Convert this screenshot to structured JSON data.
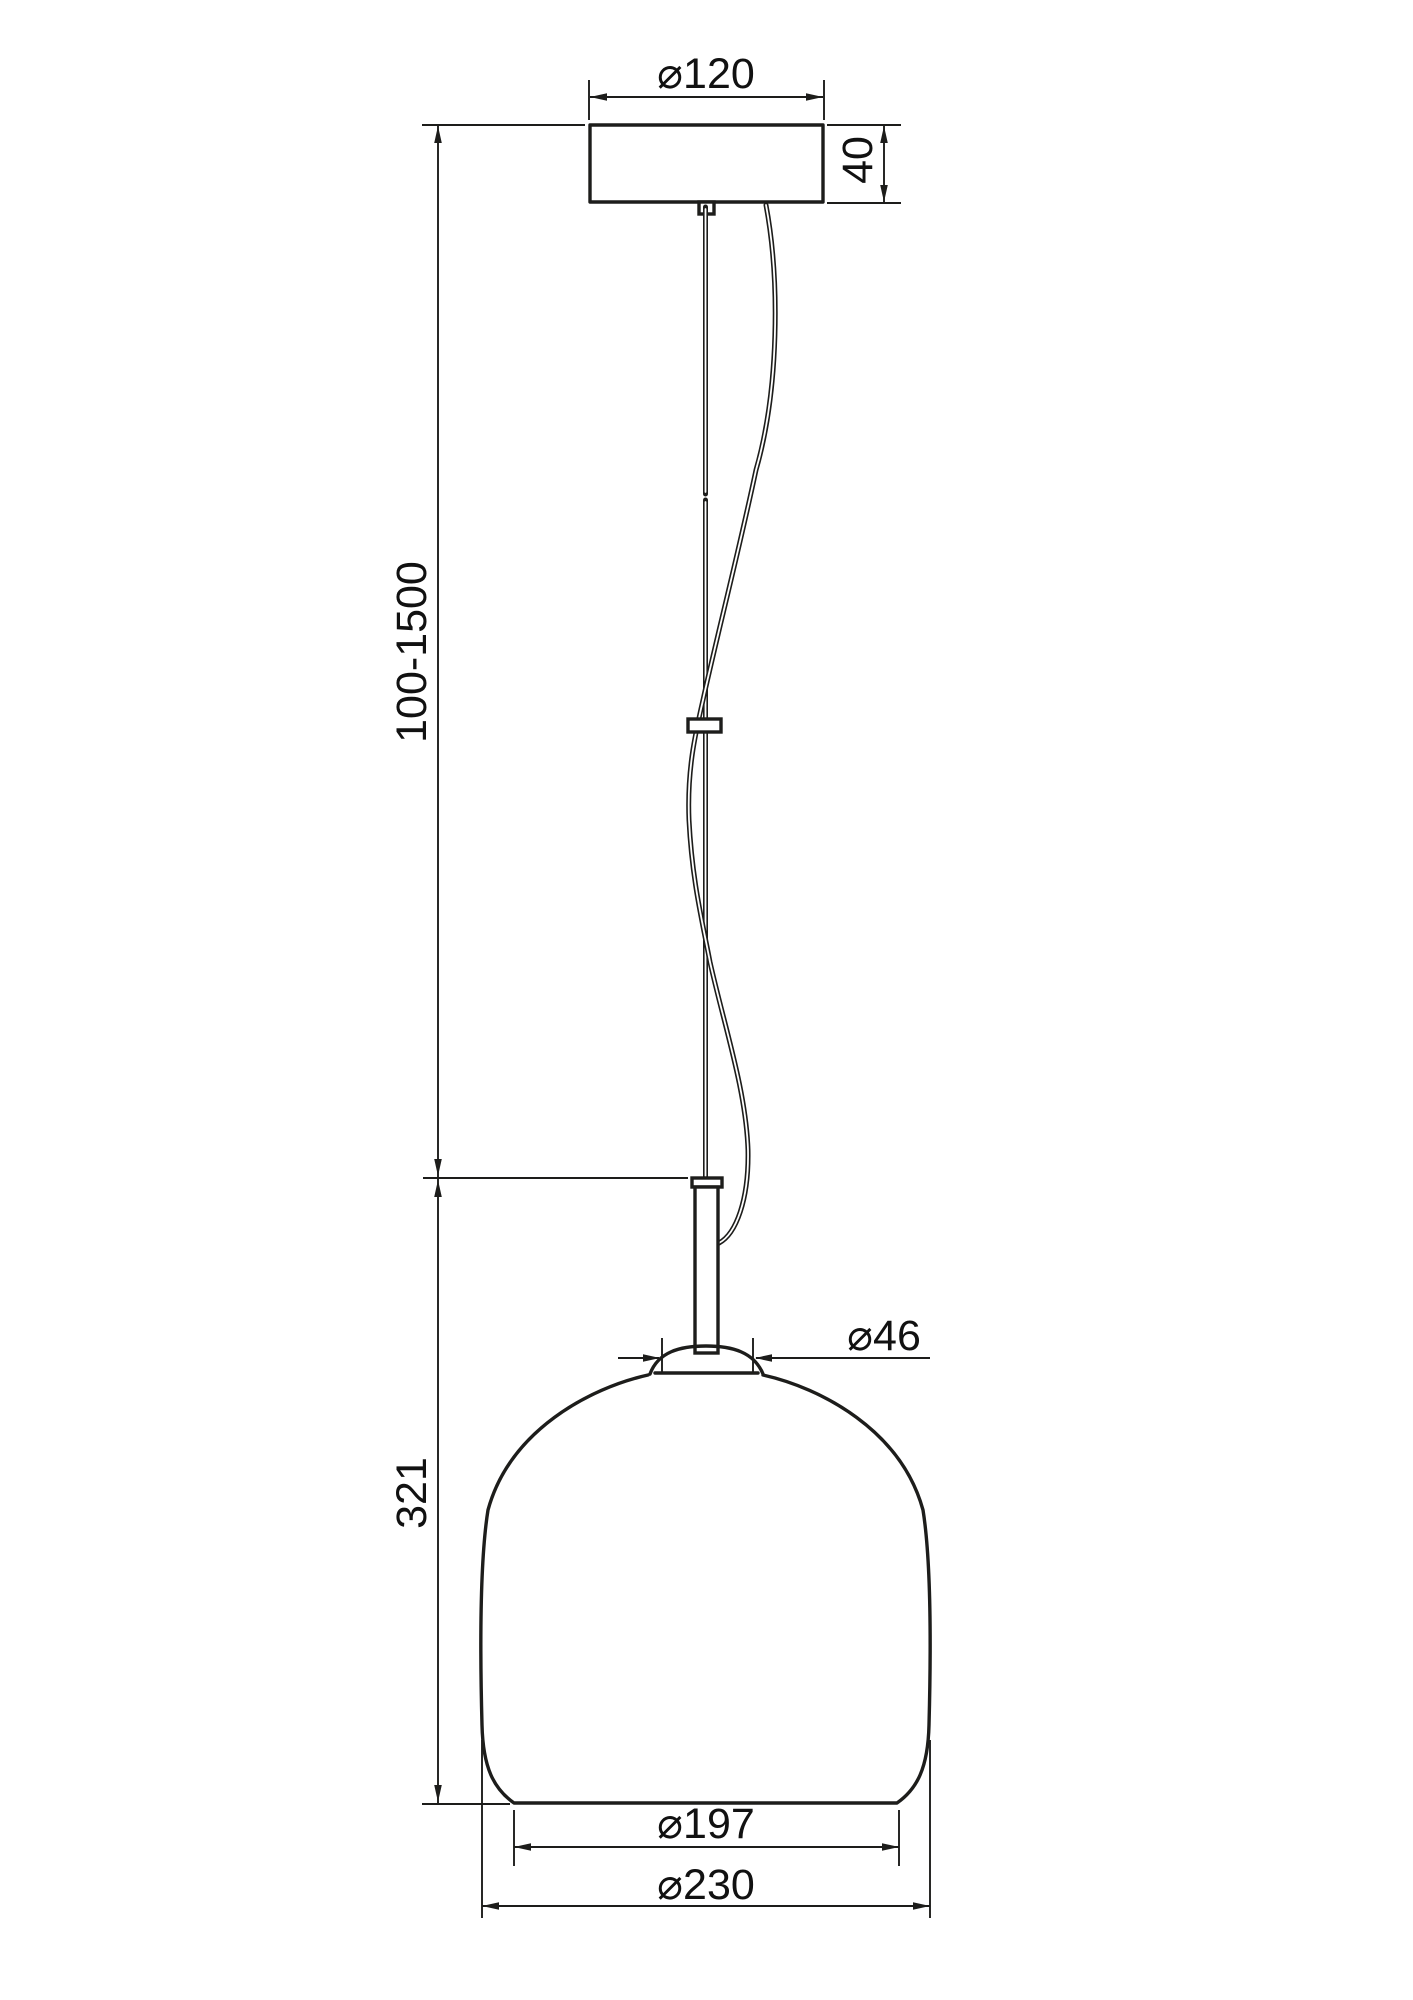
{
  "drawing": {
    "kind": "pendant-lamp-dimension-drawing"
  },
  "dimensions": {
    "canopy_diameter": "⌀120",
    "canopy_height": "40",
    "suspension_length": "100-1500",
    "shade_height": "321",
    "neck_diameter": "⌀46",
    "shade_bottom_inner_diameter": "⌀197",
    "shade_outer_diameter": "⌀230"
  },
  "colors": {
    "line": "#1d1d1b",
    "text": "#111111",
    "background": "#ffffff"
  }
}
